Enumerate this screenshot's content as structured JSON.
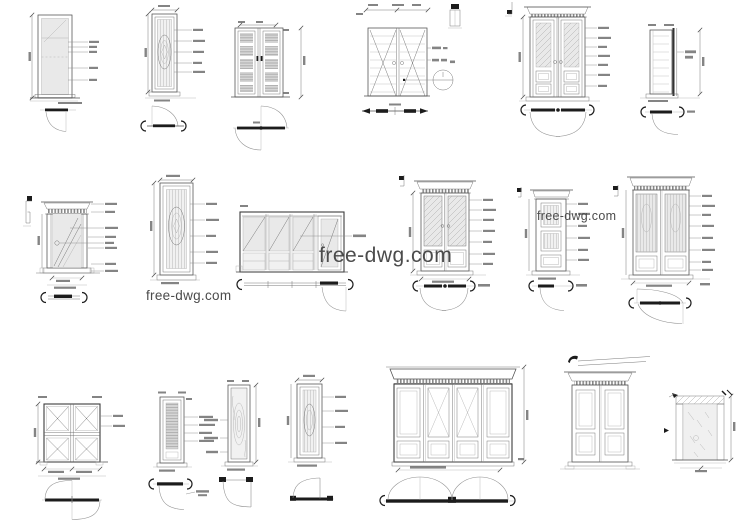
{
  "sheet": {
    "background": "#ffffff",
    "line_color": "#4f4f4f",
    "glass_color": "#e9e9e9",
    "watermark_color": "#4b4b4b"
  },
  "watermarks": {
    "center": {
      "text": "free-dwg.com"
    },
    "left": {
      "text": "free-dwg.com"
    },
    "right": {
      "text": "free-dwg.com"
    }
  }
}
